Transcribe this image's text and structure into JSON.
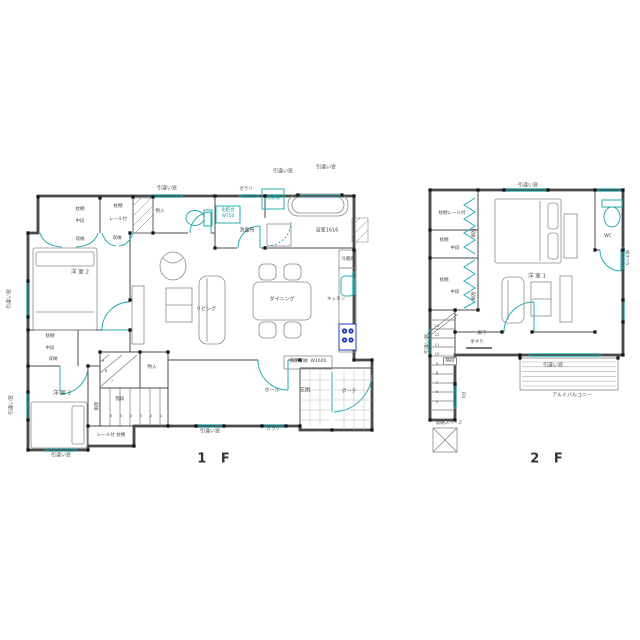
{
  "document": {
    "type": "architectural-floor-plan",
    "background": "#ffffff"
  },
  "colors": {
    "wall": "#4a4a4a",
    "window_teal": "#25aeb1",
    "furniture": "#8a8a8a",
    "stove_blue": "#2438c8",
    "text": "#4a4a4a",
    "label_teal": "#1f9ea1"
  },
  "floors": [
    {
      "id": "1f",
      "title": "1 F",
      "rooms": [
        "洋 室 2",
        "洋 室 3",
        "リビング",
        "ダイニング",
        "キッチン",
        "洗面所",
        "浴室1616",
        "玄関",
        "ホール",
        "ポーチ",
        "階段",
        "物入",
        "収納"
      ]
    },
    {
      "id": "2f",
      "title": "2 F",
      "rooms": [
        "洋 室 1",
        "WC",
        "廊下",
        "階段",
        "収納スペース",
        "アルミバルコニー"
      ]
    }
  ],
  "labels": [
    {
      "name": "win-label-top-toilet",
      "text": "引違い窓",
      "x": 167,
      "y": 189
    },
    {
      "name": "louver-label-top",
      "text": "ガラリ",
      "x": 246,
      "y": 190,
      "size": 4.5
    },
    {
      "name": "win-label-top-wash",
      "text": "引違い窓",
      "x": 283,
      "y": 172
    },
    {
      "name": "win-label-top-bath",
      "text": "引違い窓",
      "x": 326,
      "y": 168
    },
    {
      "name": "washer-label",
      "text": "洗濯機",
      "x": 273,
      "y": 199,
      "size": 4.5,
      "cls": "teal"
    },
    {
      "name": "vanity-label",
      "text": "化粧台",
      "x": 228,
      "y": 211,
      "size": 4.5,
      "cls": "teal"
    },
    {
      "name": "vanity-size-label",
      "text": "W750",
      "x": 228,
      "y": 217,
      "size": 4.5,
      "cls": "teal"
    },
    {
      "name": "washroom-label",
      "text": "洗面所",
      "x": 247,
      "y": 231
    },
    {
      "name": "bathroom-label",
      "text": "浴室1616",
      "x": 327,
      "y": 231
    },
    {
      "name": "fridge-label",
      "text": "冷蔵庫",
      "x": 348,
      "y": 260,
      "size": 4.5
    },
    {
      "name": "kitchen-label",
      "text": "キッチン",
      "x": 336,
      "y": 300,
      "size": 4.5
    },
    {
      "name": "dining-label",
      "text": "ダイニング",
      "x": 282,
      "y": 300
    },
    {
      "name": "living-label",
      "text": "リビング",
      "x": 206,
      "y": 310
    },
    {
      "name": "shelf-label-a",
      "text": "枕棚",
      "x": 80,
      "y": 210,
      "size": 4.5
    },
    {
      "name": "midshelf-label-a",
      "text": "中段",
      "x": 80,
      "y": 222,
      "size": 4.5
    },
    {
      "name": "shelf-label-b",
      "text": "枕棚",
      "x": 118,
      "y": 207,
      "size": 4.5
    },
    {
      "name": "rail-label-b",
      "text": "レール付",
      "x": 118,
      "y": 220,
      "size": 4.5
    },
    {
      "name": "storage-label-a",
      "text": "収納",
      "x": 80,
      "y": 240,
      "size": 4.5
    },
    {
      "name": "storage-label-b",
      "text": "収納",
      "x": 117,
      "y": 239,
      "size": 4.5
    },
    {
      "name": "closet-label-top",
      "text": "物入",
      "x": 160,
      "y": 212,
      "size": 4.5
    },
    {
      "name": "room2-label",
      "text": "洋 室 2",
      "x": 80,
      "y": 273,
      "size": 5.5
    },
    {
      "name": "shelf-label-c",
      "text": "枕棚",
      "x": 50,
      "y": 337,
      "size": 4.5
    },
    {
      "name": "midshelf-label-c",
      "text": "中段",
      "x": 50,
      "y": 349,
      "size": 4.5
    },
    {
      "name": "storage-label-c",
      "text": "収納",
      "x": 53,
      "y": 360,
      "size": 4.5
    },
    {
      "name": "room3-label",
      "text": "洋 室 3",
      "x": 62,
      "y": 394,
      "size": 5.5
    },
    {
      "name": "closet-label-stair",
      "text": "物入",
      "x": 152,
      "y": 368,
      "size": 4.5
    },
    {
      "name": "stair-label-1f",
      "text": "階段",
      "x": 120,
      "y": 400,
      "size": 4.5
    },
    {
      "name": "storage-label-d",
      "text": "収納",
      "x": 94,
      "y": 406,
      "size": 4.5,
      "rot": 90
    },
    {
      "name": "rail-shelf-label",
      "text": "レール付 枕棚",
      "x": 111,
      "y": 436,
      "size": 4.5
    },
    {
      "name": "entry-storage-label",
      "text": "玄関収納  W1600",
      "x": 308,
      "y": 362,
      "size": 4.5
    },
    {
      "name": "hall-label",
      "text": "ホール",
      "x": 272,
      "y": 391
    },
    {
      "name": "entry-label",
      "text": "玄関",
      "x": 305,
      "y": 391
    },
    {
      "name": "porch-label",
      "text": "ポーチ",
      "x": 349,
      "y": 392
    },
    {
      "name": "win-label-bottom",
      "text": "引違い窓",
      "x": 210,
      "y": 432
    },
    {
      "name": "louver-label-bottom",
      "text": "ガラリ",
      "x": 273,
      "y": 430,
      "size": 4.5
    },
    {
      "name": "win-label-left-1",
      "text": "引違い窓",
      "x": 10,
      "y": 299,
      "rot": -90
    },
    {
      "name": "win-label-left-2",
      "text": "引違い窓",
      "x": 12,
      "y": 405,
      "rot": -90
    },
    {
      "name": "win-label-room3",
      "text": "引違い窓",
      "x": 61,
      "y": 456
    },
    {
      "name": "stair1f-num-1",
      "text": "1",
      "x": 161,
      "y": 416,
      "size": 3.8
    },
    {
      "name": "stair1f-num-2",
      "text": "2",
      "x": 151,
      "y": 416,
      "size": 3.8
    },
    {
      "name": "stair1f-num-3",
      "text": "3",
      "x": 141,
      "y": 416,
      "size": 3.8
    },
    {
      "name": "stair1f-num-4",
      "text": "4",
      "x": 131,
      "y": 416,
      "size": 3.8
    },
    {
      "name": "stair1f-num-5",
      "text": "5",
      "x": 121,
      "y": 416,
      "size": 3.8
    },
    {
      "name": "stair1f-num-6",
      "text": "6",
      "x": 111,
      "y": 416,
      "size": 3.8
    },
    {
      "name": "stair1f-num-7",
      "text": "7",
      "x": 112,
      "y": 381,
      "size": 3.8
    },
    {
      "name": "stair1f-num-8",
      "text": "8",
      "x": 106,
      "y": 371,
      "size": 3.8
    },
    {
      "name": "stair1f-num-9",
      "text": "9",
      "x": 103,
      "y": 361,
      "size": 3.8
    },
    {
      "name": "win-label-2f-top",
      "text": "引違い窓",
      "x": 528,
      "y": 186
    },
    {
      "name": "shelf-rail-label-2f",
      "text": "枕棚レール付",
      "x": 452,
      "y": 214,
      "size": 4.5
    },
    {
      "name": "shelf-2f-a",
      "text": "枕棚",
      "x": 444,
      "y": 241,
      "size": 4.5
    },
    {
      "name": "mid-2f-a",
      "text": "中段",
      "x": 455,
      "y": 249,
      "size": 4.5
    },
    {
      "name": "shelf-2f-b",
      "text": "枕棚",
      "x": 444,
      "y": 281,
      "size": 4.5
    },
    {
      "name": "mid-2f-b",
      "text": "中段",
      "x": 455,
      "y": 293,
      "size": 4.5
    },
    {
      "name": "sto-2f-a",
      "text": "収納",
      "x": 471,
      "y": 233,
      "size": 4.5,
      "rot": 90
    },
    {
      "name": "sto-2f-b",
      "text": "収納",
      "x": 471,
      "y": 296,
      "size": 4.5,
      "rot": 90
    },
    {
      "name": "room1-label",
      "text": "洋 室 1",
      "x": 537,
      "y": 277,
      "size": 5.5
    },
    {
      "name": "wc-label",
      "text": "WC",
      "x": 608,
      "y": 237,
      "size": 4.5
    },
    {
      "name": "hallway-label",
      "text": "廊下",
      "x": 482,
      "y": 334,
      "size": 4.5
    },
    {
      "name": "handrail-label",
      "text": "手すり",
      "x": 477,
      "y": 343,
      "size": 4.5
    },
    {
      "name": "stair-label-2f",
      "text": "階段",
      "x": 450,
      "y": 361,
      "size": 4.5,
      "cls": "boxed"
    },
    {
      "name": "fix-label",
      "text": "FIX",
      "x": 463,
      "y": 395,
      "size": 4,
      "rot": 90
    },
    {
      "name": "win-label-2f-left",
      "text": "引違い窓",
      "x": 428,
      "y": 344,
      "rot": -90
    },
    {
      "name": "win-label-balcony",
      "text": "引違い窓",
      "x": 553,
      "y": 366
    },
    {
      "name": "balcony-label",
      "text": "アルミバルコニー",
      "x": 572,
      "y": 396
    },
    {
      "name": "attic-label",
      "text": "収納スペース",
      "x": 449,
      "y": 424,
      "size": 4.5
    },
    {
      "name": "slide-win-label-2f-right",
      "text": "縦すべり",
      "x": 627,
      "y": 258,
      "size": 4,
      "rot": 90
    },
    {
      "name": "stair2f-num-13",
      "text": "13",
      "x": 437,
      "y": 326,
      "size": 3.8
    },
    {
      "name": "stair2f-num-12",
      "text": "12",
      "x": 437,
      "y": 335,
      "size": 3.8
    },
    {
      "name": "stair2f-num-11",
      "text": "11",
      "x": 437,
      "y": 345,
      "size": 3.8
    },
    {
      "name": "stair2f-num-10",
      "text": "10",
      "x": 437,
      "y": 354,
      "size": 3.8
    },
    {
      "name": "stair2f-num-9",
      "text": "9",
      "x": 437,
      "y": 364,
      "size": 3.8
    },
    {
      "name": "stair2f-num-8",
      "text": "8",
      "x": 437,
      "y": 373,
      "size": 3.8
    },
    {
      "name": "stair2f-num-7",
      "text": "7",
      "x": 437,
      "y": 383,
      "size": 3.8
    },
    {
      "name": "stair2f-num-6",
      "text": "6",
      "x": 437,
      "y": 392,
      "size": 3.8
    },
    {
      "name": "stair2f-num-5",
      "text": "5",
      "x": 437,
      "y": 402,
      "size": 3.8
    }
  ]
}
